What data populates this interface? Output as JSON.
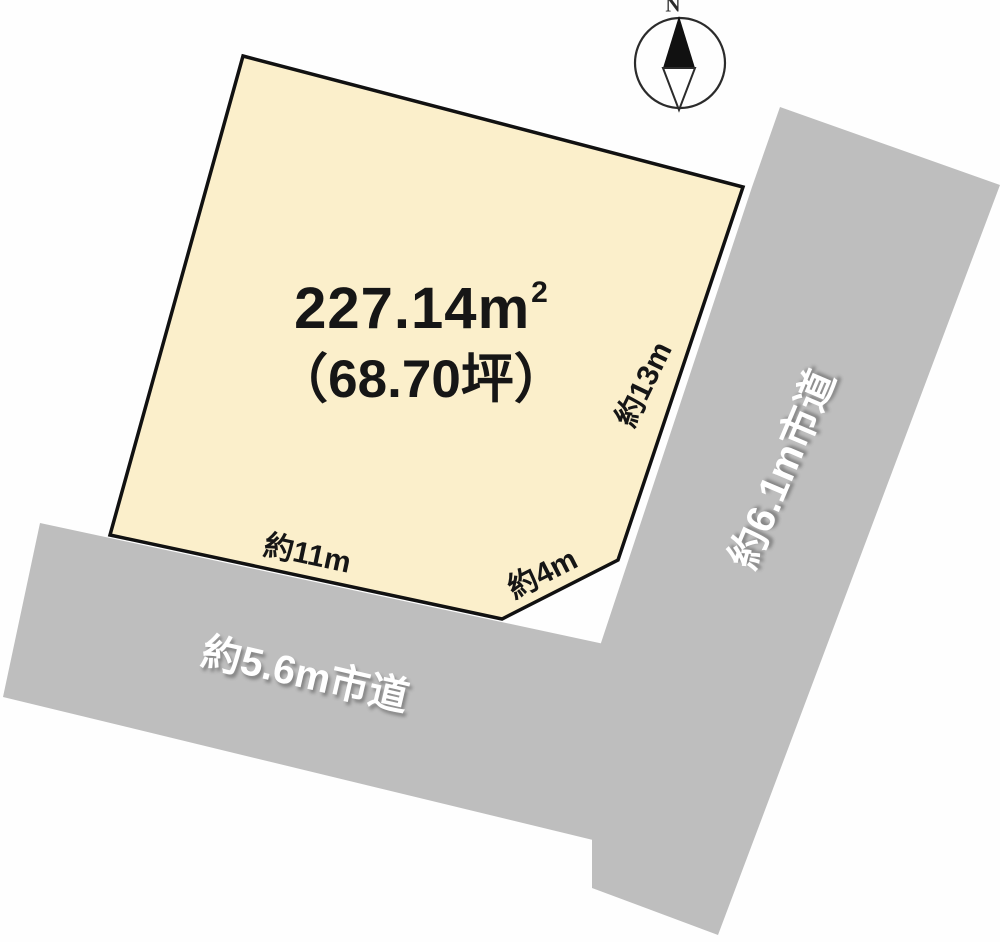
{
  "parcel": {
    "area_value": "227.14m",
    "area_unit_exp": "2",
    "area_tsubo": "（68.70坪）",
    "dim_right": "約13m",
    "dim_bottom": "約11m",
    "dim_corner": "約4m"
  },
  "roads": {
    "bottom_label": "約5.6m市道",
    "right_label": "約6.1m市道"
  },
  "compass": {
    "north_label": "N"
  },
  "colors": {
    "parcel_fill": "#FBEFCB",
    "parcel_stroke": "#111111",
    "road_fill": "#BEBEBE",
    "compass_stroke": "#2b2b2b",
    "compass_needle_fill": "#111111",
    "label_white": "#ffffff"
  }
}
